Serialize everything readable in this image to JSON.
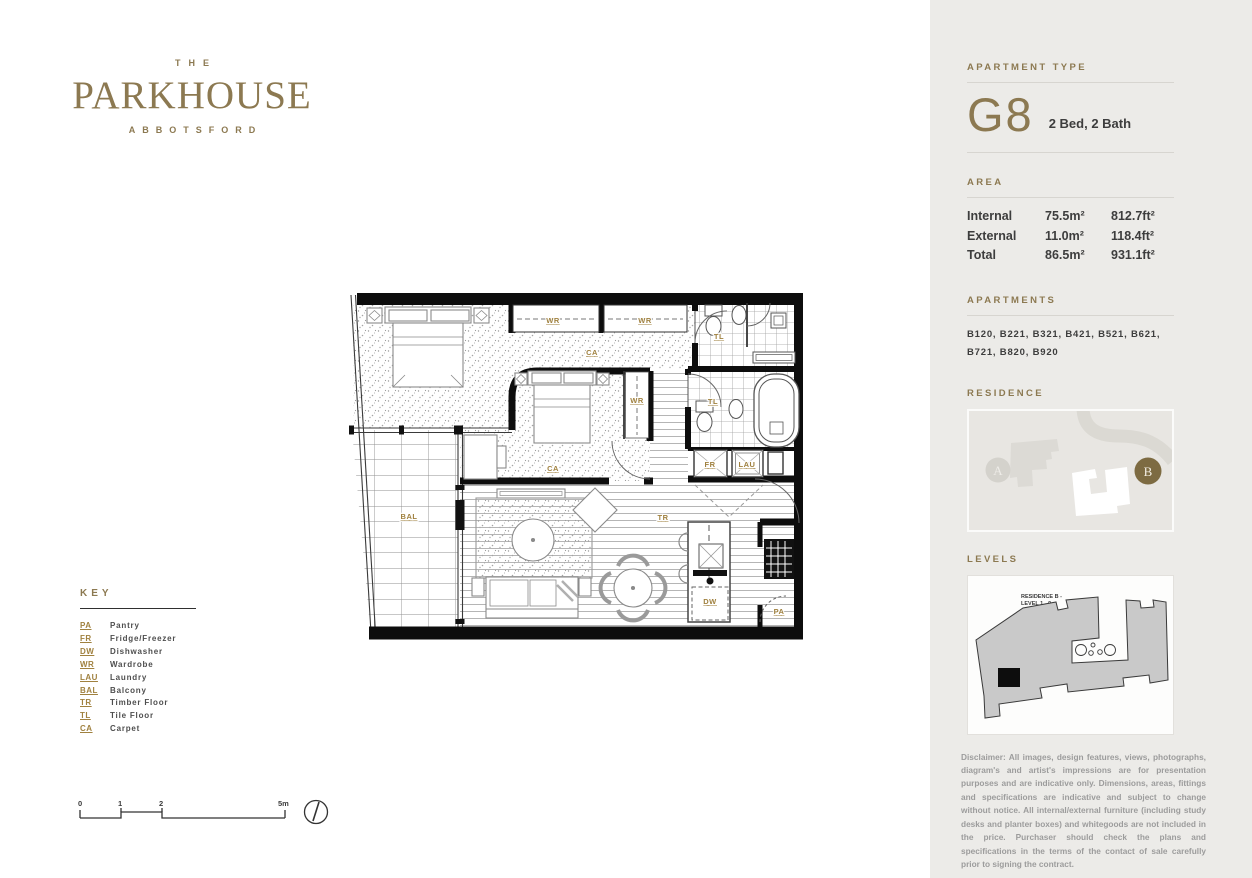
{
  "brand": {
    "the": "THE",
    "name": "PARKHOUSE",
    "suburb": "ABBOTSFORD"
  },
  "sidebar": {
    "apartment_type_label": "APARTMENT TYPE",
    "type_code": "G8",
    "type_desc": "2 Bed, 2 Bath",
    "area_label": "AREA",
    "area_rows": [
      {
        "label": "Internal",
        "m2": "75.5m²",
        "ft2": "812.7ft²"
      },
      {
        "label": "External",
        "m2": "11.0m²",
        "ft2": "118.4ft²"
      },
      {
        "label": "Total",
        "m2": "86.5m²",
        "ft2": "931.1ft²"
      }
    ],
    "apartments_label": "APARTMENTS",
    "apartments_list": "B120, B221, B321, B421, B521, B621, B721, B820, B920",
    "residence_label": "RESIDENCE",
    "residence_markers": {
      "a": "A",
      "b": "B"
    },
    "levels_label": "LEVELS",
    "levels_caption_line1": "RESIDENCE B -",
    "levels_caption_line2": "LEVEL 1 - 9",
    "disclaimer": "Disclaimer: All images, design features, views, photographs, diagram's and artist's impressions are for presentation purposes and are indicative only. Dimensions, areas, fittings and specifications are indicative and subject to change without notice. All internal/external furniture (including study desks and planter boxes) and whitegoods are not included in the price. Purchaser should check the plans and specifications in the terms of the contact of sale carefully prior to signing the contract."
  },
  "key": {
    "heading": "KEY",
    "items": [
      {
        "abbr": "PA",
        "label": "Pantry"
      },
      {
        "abbr": "FR",
        "label": "Fridge/Freezer"
      },
      {
        "abbr": "DW",
        "label": "Dishwasher"
      },
      {
        "abbr": "WR",
        "label": "Wardrobe"
      },
      {
        "abbr": "LAU",
        "label": "Laundry"
      },
      {
        "abbr": "BAL",
        "label": "Balcony"
      },
      {
        "abbr": "TR",
        "label": "Timber Floor"
      },
      {
        "abbr": "TL",
        "label": "Tile Floor"
      },
      {
        "abbr": "CA",
        "label": "Carpet"
      }
    ]
  },
  "scale": {
    "t0": "0",
    "t1": "1",
    "t2": "2",
    "t3": "5m"
  },
  "floorplan": {
    "labels": {
      "bal": "BAL",
      "wr1": "WR",
      "wr2": "WR",
      "wr3": "WR",
      "ca1": "CA",
      "ca2": "CA",
      "tl1": "TL",
      "tl2": "TL",
      "tr": "TR",
      "fr": "FR",
      "lau": "LAU",
      "dw": "DW",
      "pa": "PA"
    }
  },
  "colors": {
    "gold": "#8c7951",
    "plan_label_gold": "#a0813f",
    "sidebar_bg": "#ecebe8",
    "text_dark": "#3d3d3d",
    "disclaimer_gray": "#9c9c9c",
    "marker_b": "#7d6b42"
  }
}
